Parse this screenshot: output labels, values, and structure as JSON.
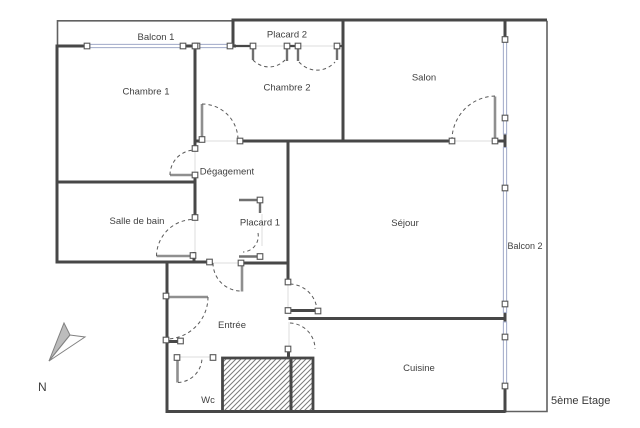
{
  "title": "Plan d'appartement",
  "floor_label": "5ème Etage",
  "compass": {
    "north_label": "N"
  },
  "rooms": [
    {
      "id": "balcon-1",
      "label": "Balcon 1"
    },
    {
      "id": "placard-2",
      "label": "Placard 2"
    },
    {
      "id": "chambre-1",
      "label": "Chambre 1"
    },
    {
      "id": "chambre-2",
      "label": "Chambre 2"
    },
    {
      "id": "salon",
      "label": "Salon"
    },
    {
      "id": "degagement",
      "label": "Dégagement"
    },
    {
      "id": "salle-de-bain",
      "label": "Salle de bain"
    },
    {
      "id": "placard-1",
      "label": "Placard 1"
    },
    {
      "id": "sejour",
      "label": "Séjour"
    },
    {
      "id": "balcon-2",
      "label": "Balcon 2"
    },
    {
      "id": "entree",
      "label": "Entrée"
    },
    {
      "id": "cuisine",
      "label": "Cuisine"
    },
    {
      "id": "wc",
      "label": "Wc"
    }
  ],
  "colors": {
    "wall": "#474747",
    "door_leaf": "#8f8f8f",
    "window": "#a8b1cd",
    "hatch": "#7a7a7a",
    "text": "#3f3f3f"
  }
}
